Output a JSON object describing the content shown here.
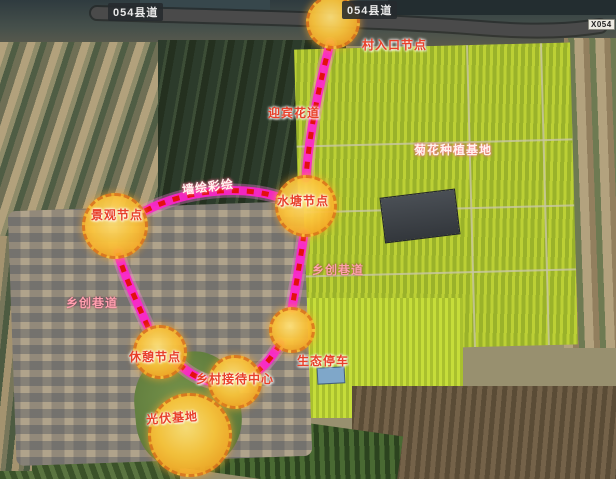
{
  "road": {
    "tag_left": "054县道",
    "tag_mid": "054县道",
    "tag_right": "X054"
  },
  "nodes": {
    "entrance": "村入口节点",
    "pond": "水塘节点",
    "landscape": "景观节点",
    "rest": "休憩节点",
    "reception": "乡村接待中心",
    "parking": "生态停车",
    "solar": "光伏基地"
  },
  "paths": {
    "flower": "迎宾花道",
    "mural": "墙绘彩绘",
    "lane_left": "乡创巷道",
    "lane_right": "乡创巷道"
  },
  "areas": {
    "chrysanthemum": "菊花种植基地"
  },
  "colors": {
    "route_magenta": "#ff22cc",
    "route_dash_red": "#e30f0f",
    "node_fill": "#f7b61e",
    "node_border": "#e0791c",
    "label_red": "#e8402a",
    "label_white": "#fff4ef",
    "label_pink": "#ff9fae",
    "road_gray": "#474747"
  }
}
